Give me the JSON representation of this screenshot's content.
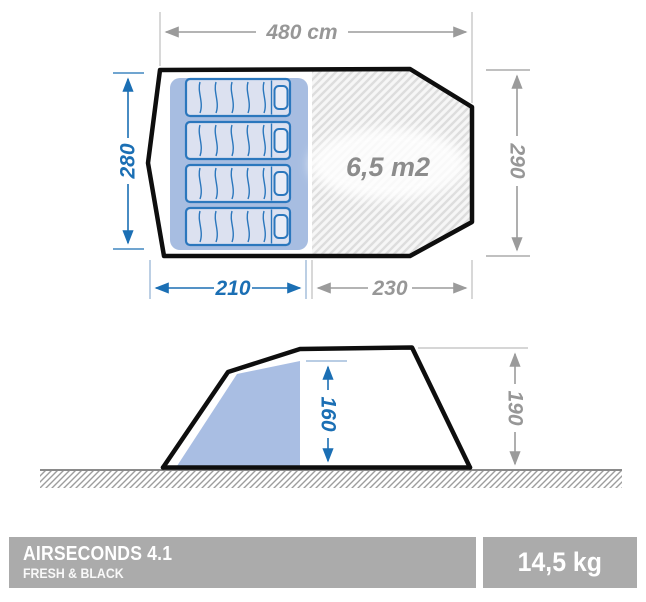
{
  "floor_plan": {
    "width_label": "480 cm",
    "depth_left_label": "280",
    "depth_right_label": "290",
    "bedroom_width_label": "210",
    "living_width_label": "230",
    "living_area_label": "6,5 m2"
  },
  "side_view": {
    "inner_height_label": "160",
    "outer_height_label": "190"
  },
  "footer": {
    "product_name": "AIRSECONDS 4.1",
    "product_line": "FRESH & BLACK",
    "weight": "14,5 kg"
  },
  "colors": {
    "accent_blue": "#1b6fb4",
    "dim_gray": "#9b9b9b",
    "bar_gray": "#ababab"
  }
}
